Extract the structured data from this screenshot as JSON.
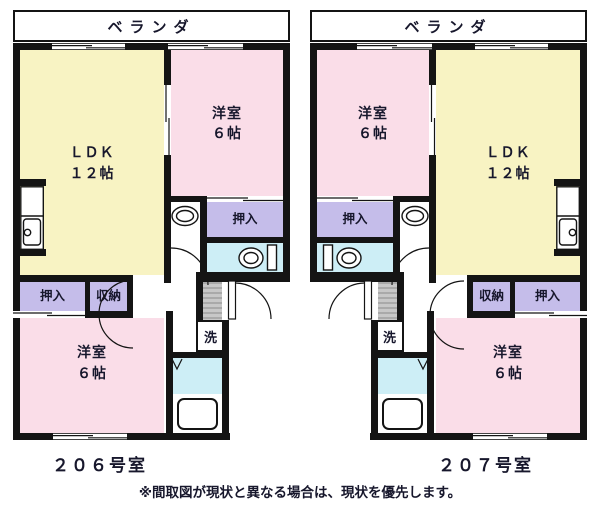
{
  "caption": "※間取図が現状と異なる場合は、現状を優先します。",
  "colors": {
    "bg": "#ffffff",
    "wall": "#141414",
    "text": "#17172c",
    "ldk": "#f8f3c3",
    "bedroom": "#fadde8",
    "closet": "#c5bdea",
    "wet": "#cdeef6",
    "genkan": "#b5b5b5"
  },
  "units": [
    {
      "unit_label": "２０６号室",
      "veranda_label": "ベランダ",
      "ldk": {
        "name": "ＬＤＫ",
        "size": "１２帖"
      },
      "bedroom_top": {
        "name": "洋室",
        "size": "６帖"
      },
      "bedroom_bottom": {
        "name": "洋室",
        "size": "６帖"
      },
      "closet_top": "押入",
      "closet_bottom": "押入",
      "storage": "収納",
      "laundry": "洗"
    },
    {
      "unit_label": "２０７号室",
      "veranda_label": "ベランダ",
      "ldk": {
        "name": "ＬＤＫ",
        "size": "１２帖"
      },
      "bedroom_top": {
        "name": "洋室",
        "size": "６帖"
      },
      "bedroom_bottom": {
        "name": "洋室",
        "size": "６帖"
      },
      "closet_top": "押入",
      "closet_bottom": "押入",
      "storage": "収納",
      "laundry": "洗"
    }
  ]
}
